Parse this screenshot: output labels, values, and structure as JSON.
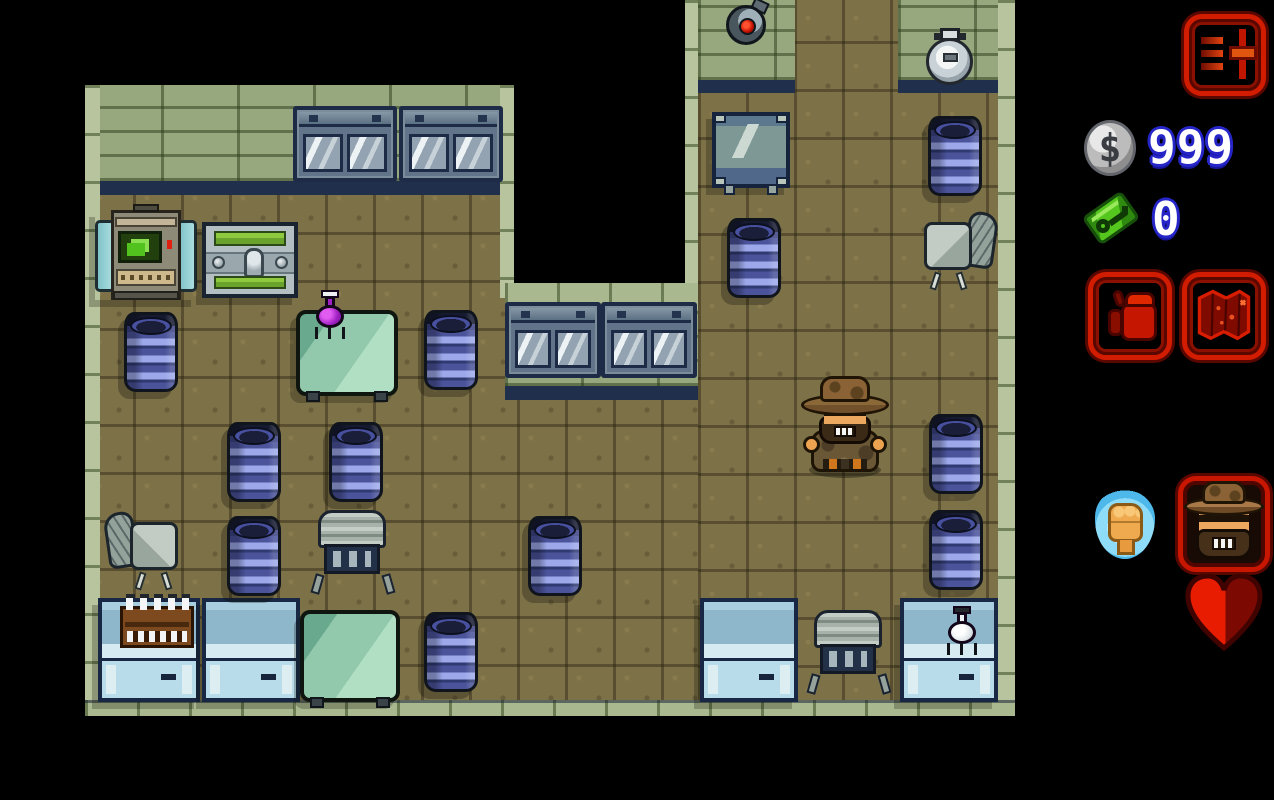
{
  "hud": {
    "settings_button": {
      "icon": "settings-sliders-icon"
    },
    "currency": {
      "icon": "dollar-coin-icon",
      "symbol": "$",
      "value": "999"
    },
    "keys": {
      "icon": "key-icon",
      "value": "0"
    },
    "inventory_button": {
      "icon": "backpack-icon"
    },
    "map_button": {
      "icon": "map-icon"
    },
    "ability_slot": {
      "icon": "punch-fist-icon"
    },
    "portrait": {
      "icon": "hopper-portrait-icon",
      "character": "Hopper"
    },
    "health": {
      "icon": "heart-icon",
      "state": "partial"
    }
  },
  "colors": {
    "background": "#000000",
    "hud_accent_red": "#d21c00",
    "hud_text_fill": "#ffffff",
    "hud_text_outline": "#2626c8",
    "floor_tan": "#7d7148",
    "wall_sage": "#97a77e",
    "barrel_blue": "#4b539b",
    "counter_blue": "#8fb7cc",
    "table_green": "#92c9ad",
    "flask_purple": "#a021c4",
    "key_green": "#55c61e"
  },
  "scene": {
    "setting": "top-down pixel-art laboratory rooms",
    "player": {
      "character": "Hopper",
      "x": 799,
      "y": 374
    },
    "barrels": [
      {
        "x": 124,
        "y": 312
      },
      {
        "x": 424,
        "y": 310
      },
      {
        "x": 227,
        "y": 422
      },
      {
        "x": 329,
        "y": 422
      },
      {
        "x": 227,
        "y": 516
      },
      {
        "x": 528,
        "y": 516
      },
      {
        "x": 424,
        "y": 612
      },
      {
        "x": 928,
        "y": 116
      },
      {
        "x": 727,
        "y": 218
      },
      {
        "x": 929,
        "y": 414
      },
      {
        "x": 929,
        "y": 510
      }
    ],
    "furniture": [
      {
        "type": "computer-terminal",
        "x": 95,
        "y": 210
      },
      {
        "type": "supply-chest",
        "x": 202,
        "y": 222
      },
      {
        "type": "glass-wall-cabinet",
        "x": 293,
        "y": 106
      },
      {
        "type": "glass-wall-cabinet",
        "x": 399,
        "y": 106
      },
      {
        "type": "glass-wall-cabinet",
        "x": 505,
        "y": 302
      },
      {
        "type": "glass-wall-cabinet",
        "x": 601,
        "y": 302
      },
      {
        "type": "lab-table-with-purple-flask",
        "x": 296,
        "y": 310
      },
      {
        "type": "office-chair",
        "x": 106,
        "y": 510
      },
      {
        "type": "office-chair",
        "x": 922,
        "y": 210
      },
      {
        "type": "utility-cart",
        "x": 310,
        "y": 510
      },
      {
        "type": "utility-cart",
        "x": 806,
        "y": 610
      },
      {
        "type": "lab-counter-with-test-tubes",
        "x": 98,
        "y": 598
      },
      {
        "type": "lab-counter",
        "x": 202,
        "y": 598
      },
      {
        "type": "lab-counter",
        "x": 700,
        "y": 598
      },
      {
        "type": "lab-counter-with-white-flask",
        "x": 900,
        "y": 598
      },
      {
        "type": "green-table",
        "x": 300,
        "y": 610
      },
      {
        "type": "metal-desk",
        "x": 712,
        "y": 112
      },
      {
        "type": "security-camera",
        "x": 724,
        "y": 0
      },
      {
        "type": "wall-fountain",
        "x": 924,
        "y": 28
      }
    ]
  }
}
